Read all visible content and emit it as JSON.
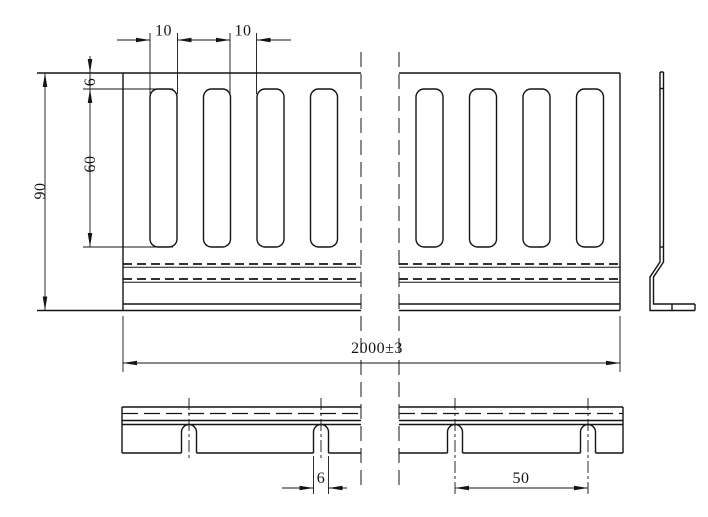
{
  "colors": {
    "background": "#ffffff",
    "line": "#141414"
  },
  "dimensions": {
    "slot_width": "10",
    "slot_spacing": "10",
    "top_margin": "6",
    "slot_height": "60",
    "plate_width": "90",
    "overall_length": "2000±3",
    "notch_width": "6",
    "notch_spacing": "50"
  }
}
